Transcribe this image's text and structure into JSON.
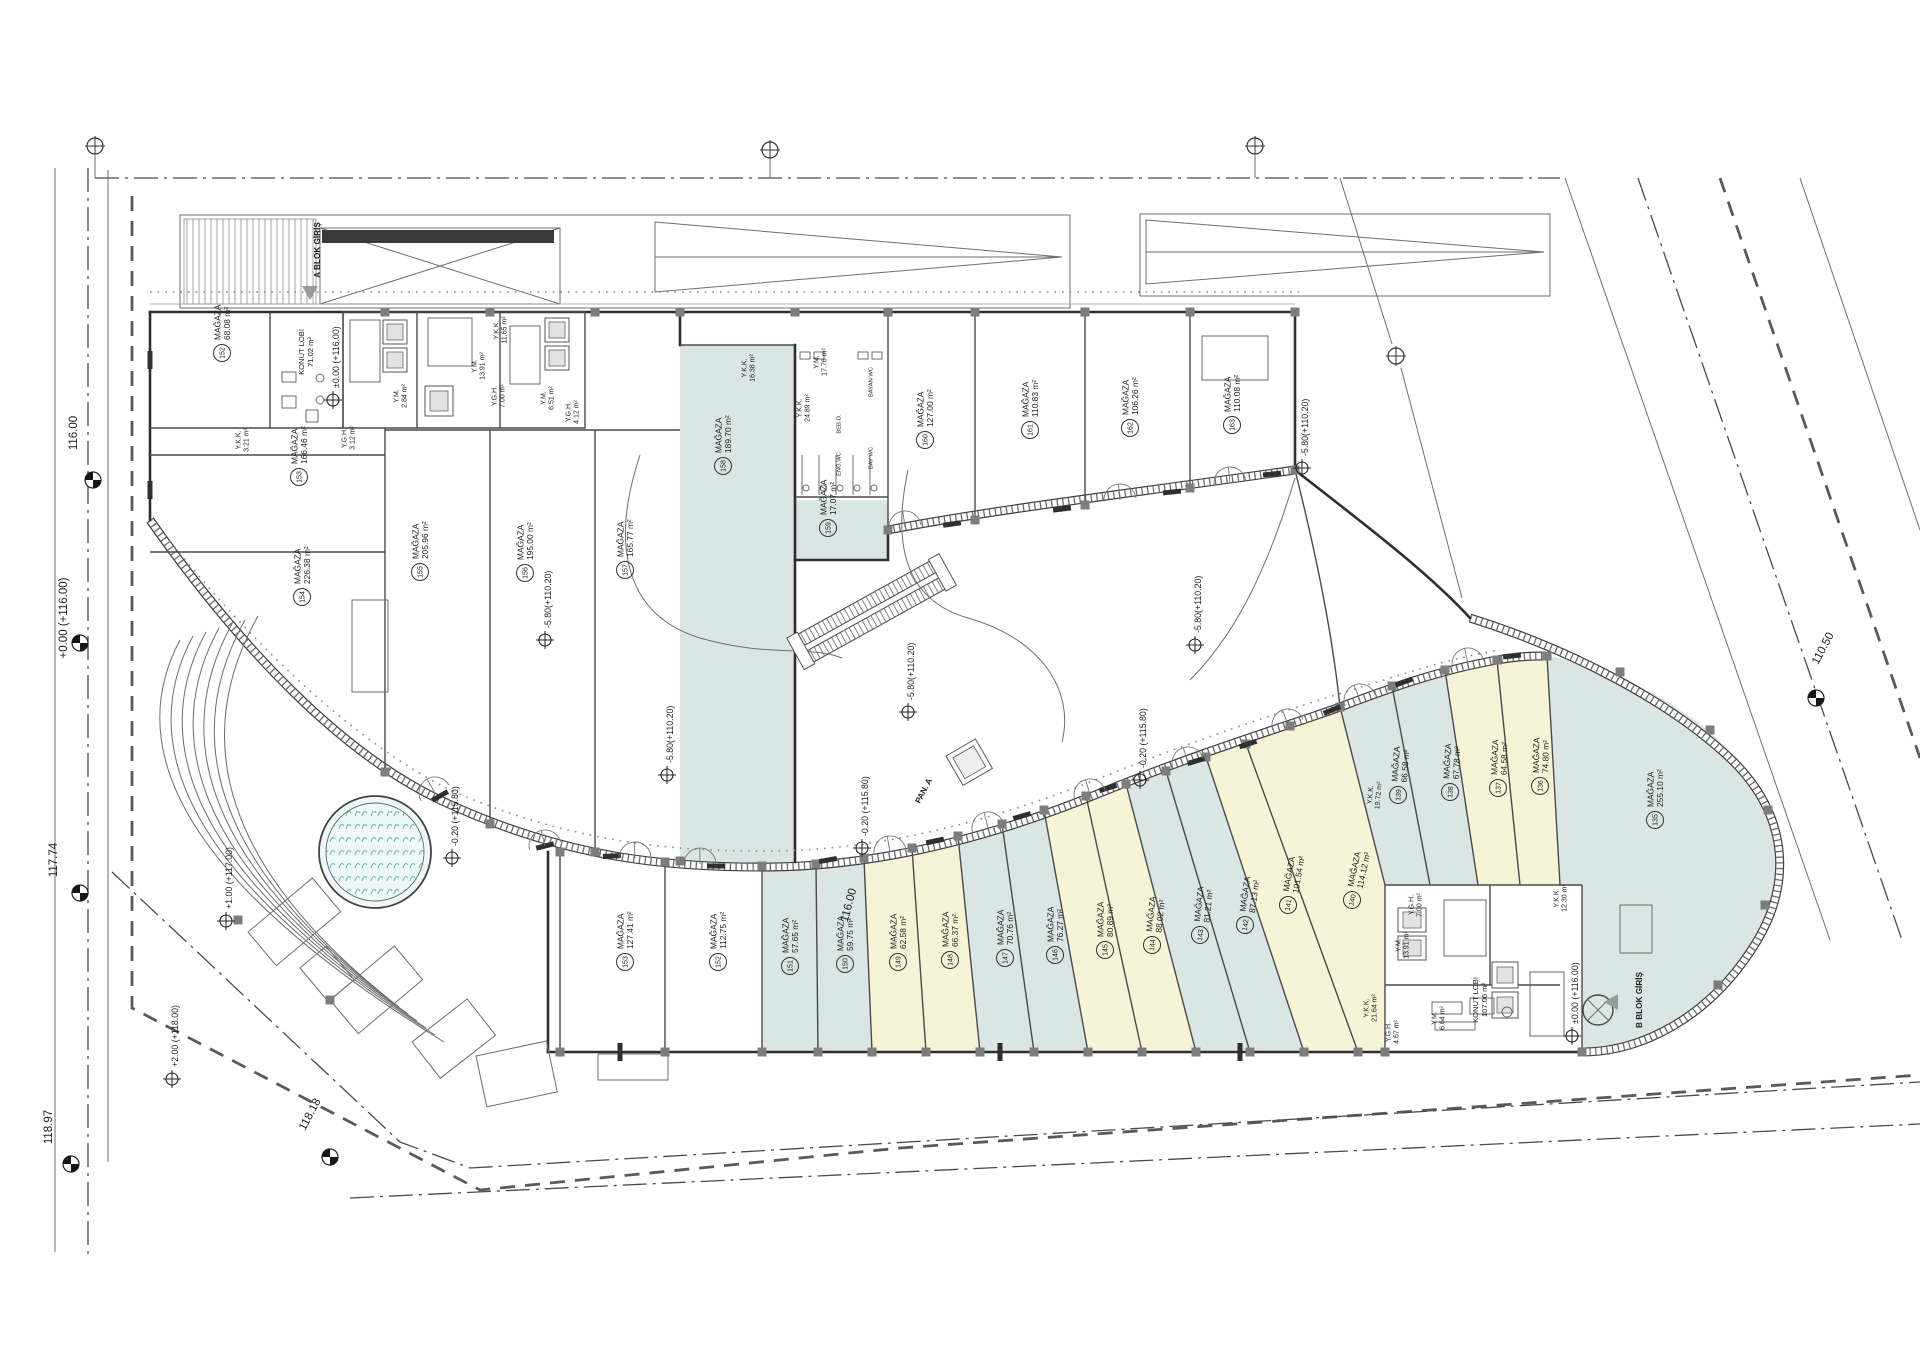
{
  "labels": {
    "shop_word": "MAĞAZA"
  },
  "colors": {
    "teal": "#d9e6e3",
    "yellow": "#f6f3d7",
    "water": "#bfe3e6",
    "wall": "#2e2e2e"
  },
  "shops": [
    {
      "no": "152",
      "area": "68.08 m²",
      "x": 222,
      "y": 353
    },
    {
      "no": "153",
      "area": "166.46 m²",
      "x": 299,
      "y": 477
    },
    {
      "no": "154",
      "area": "226.38 m²",
      "x": 302,
      "y": 597
    },
    {
      "no": "155",
      "area": "205.96 m²",
      "x": 420,
      "y": 572
    },
    {
      "no": "156",
      "area": "195.00 m²",
      "x": 525,
      "y": 573
    },
    {
      "no": "157",
      "area": "165.77 m²",
      "x": 625,
      "y": 570
    },
    {
      "no": "158",
      "area": "189.70 m²",
      "x": 723,
      "y": 466
    },
    {
      "no": "159",
      "area": "17.07 m²",
      "x": 828,
      "y": 528
    },
    {
      "no": "160",
      "area": "127.00 m²",
      "x": 925,
      "y": 440
    },
    {
      "no": "161",
      "area": "110.83 m²",
      "x": 1030,
      "y": 430
    },
    {
      "no": "162",
      "area": "106.26 m²",
      "x": 1130,
      "y": 428
    },
    {
      "no": "163",
      "area": "110.08 m²",
      "x": 1232,
      "y": 425
    },
    {
      "no": "153",
      "area": "127.41 m²",
      "x": 625,
      "y": 962
    },
    {
      "no": "152",
      "area": "112.75 m²",
      "x": 718,
      "y": 962
    },
    {
      "no": "151",
      "area": "57.65 m²",
      "x": 790,
      "y": 966
    },
    {
      "no": "150",
      "area": "59.75 m²",
      "x": 845,
      "y": 964
    },
    {
      "no": "149",
      "area": "62.58 m²",
      "x": 898,
      "y": 962
    },
    {
      "no": "148",
      "area": "66.37 m²",
      "x": 950,
      "y": 960
    },
    {
      "no": "147",
      "area": "70.76 m²",
      "x": 1005,
      "y": 958
    },
    {
      "no": "146",
      "area": "76.27 m²",
      "x": 1055,
      "y": 955
    },
    {
      "no": "145",
      "area": "80.89 m²",
      "x": 1105,
      "y": 950
    },
    {
      "no": "144",
      "area": "88.02 m²",
      "x": 1152,
      "y": 945,
      "rot": -84
    },
    {
      "no": "143",
      "area": "81.21 m²",
      "x": 1200,
      "y": 935,
      "rot": -84
    },
    {
      "no": "142",
      "area": "87.13 m²",
      "x": 1245,
      "y": 925,
      "rot": -82
    },
    {
      "no": "141",
      "area": "101.54 m²",
      "x": 1288,
      "y": 905,
      "rot": -80
    },
    {
      "no": "140",
      "area": "114.12 m²",
      "x": 1352,
      "y": 900,
      "rot": -78
    },
    {
      "no": "139",
      "area": "66.58 m²",
      "x": 1398,
      "y": 795,
      "rot": -86
    },
    {
      "no": "138",
      "area": "67.78 m²",
      "x": 1450,
      "y": 792,
      "rot": -87
    },
    {
      "no": "137",
      "area": "64.58 m²",
      "x": 1498,
      "y": 788,
      "rot": -88
    },
    {
      "no": "136",
      "area": "74.80 m²",
      "x": 1540,
      "y": 786,
      "rot": -89
    },
    {
      "no": "135",
      "area": "255.10 m²",
      "x": 1655,
      "y": 820
    }
  ],
  "rooms": [
    {
      "n": "KONUT LOBİ",
      "a": "71.02 m²",
      "x": 306,
      "y": 352
    },
    {
      "n": "Y.K.K.",
      "a": "3.21 m²",
      "x": 242,
      "y": 440
    },
    {
      "n": "Y.G.H.",
      "a": "3.12 m²",
      "x": 348,
      "y": 438
    },
    {
      "n": "Y.M.",
      "a": "2.84 m²",
      "x": 400,
      "y": 396
    },
    {
      "n": "Y.M.",
      "a": "13.91 m²",
      "x": 478,
      "y": 366
    },
    {
      "n": "Y.G.H.",
      "a": "7.00 m²",
      "x": 498,
      "y": 396
    },
    {
      "n": "Y.K.K.",
      "a": "11.65 m²",
      "x": 500,
      "y": 330
    },
    {
      "n": "Y.M.",
      "a": "6.51 m²",
      "x": 547,
      "y": 398
    },
    {
      "n": "Y.G.H.",
      "a": "4.12 m²",
      "x": 572,
      "y": 412
    },
    {
      "n": "Y.K.K.",
      "a": "16.38 m²",
      "x": 748,
      "y": 368
    },
    {
      "n": "Y.M.",
      "a": "17.76 m²",
      "x": 820,
      "y": 362
    },
    {
      "n": "Y.K.K.",
      "a": "24.89 m²",
      "x": 803,
      "y": 408
    },
    {
      "n": "BAYAN WC",
      "a": "",
      "x": 874,
      "y": 382
    },
    {
      "n": "BAY WC",
      "a": "",
      "x": 874,
      "y": 458
    },
    {
      "n": "BEB.Ö.",
      "a": "",
      "x": 842,
      "y": 424
    },
    {
      "n": "ENG.WC",
      "a": "",
      "x": 842,
      "y": 464
    },
    {
      "n": "Y.K.K.",
      "a": "19.72 m²",
      "x": 1374,
      "y": 795,
      "r": -85
    },
    {
      "n": "Y.K.K.",
      "a": "12.30 m²",
      "x": 1560,
      "y": 898
    },
    {
      "n": "Y.G.H.",
      "a": "7.00 m²",
      "x": 1415,
      "y": 905
    },
    {
      "n": "Y.M.",
      "a": "13.91 m²",
      "x": 1402,
      "y": 945
    },
    {
      "n": "Y.K.K.",
      "a": "21.64 m²",
      "x": 1370,
      "y": 1008
    },
    {
      "n": "Y.G.H.",
      "a": "4.67 m²",
      "x": 1392,
      "y": 1032
    },
    {
      "n": "Y.M.",
      "a": "6.64 m²",
      "x": 1438,
      "y": 1018
    },
    {
      "n": "KONUT LOBİ",
      "a": "107.06 m²",
      "x": 1480,
      "y": 1000
    }
  ],
  "markers": [
    {
      "t": "±0.00 (+116.00)",
      "x": 333,
      "y": 400
    },
    {
      "t": "-5.80(+110.20)",
      "x": 545,
      "y": 640
    },
    {
      "t": "-5.80(+110.20)",
      "x": 667,
      "y": 775
    },
    {
      "t": "-5.80(+110.20)",
      "x": 908,
      "y": 712
    },
    {
      "t": "-5.80(+110.20)",
      "x": 1195,
      "y": 645
    },
    {
      "t": "-5.80(+110.20)",
      "x": 1302,
      "y": 468
    },
    {
      "t": "-0.20 (+115.80)",
      "x": 452,
      "y": 858
    },
    {
      "t": "-0.20 (+115.80)",
      "x": 862,
      "y": 848
    },
    {
      "t": "-0.20 (+115.80)",
      "x": 1140,
      "y": 780
    },
    {
      "t": "+1.00 (+117.00)",
      "x": 226,
      "y": 921
    },
    {
      "t": "+2.00 (+118.00)",
      "x": 172,
      "y": 1079
    },
    {
      "t": "±0.00 (+116.00)",
      "x": 1572,
      "y": 1036
    }
  ],
  "dims": [
    {
      "t": "116.00",
      "x": 77,
      "y": 433,
      "r": -90
    },
    {
      "t": "+0.00 (+116.00)",
      "x": 67,
      "y": 618,
      "r": -90
    },
    {
      "t": "117.74",
      "x": 57,
      "y": 860,
      "r": -90
    },
    {
      "t": "118.97",
      "x": 52,
      "y": 1127,
      "r": -90
    },
    {
      "t": "118.18",
      "x": 313,
      "y": 1116,
      "r": -62
    },
    {
      "t": "110.50",
      "x": 1826,
      "y": 650,
      "r": -62
    },
    {
      "t": "116.00",
      "x": 852,
      "y": 906,
      "r": -75
    }
  ],
  "entrances": [
    {
      "t": "A BLOK GİRİŞ",
      "x": 320,
      "y": 250,
      "r": -90
    },
    {
      "t": "B BLOK GİRİŞ",
      "x": 1642,
      "y": 1000,
      "r": -90
    },
    {
      "t": "PAN. A",
      "x": 926,
      "y": 792,
      "r": -62
    }
  ]
}
